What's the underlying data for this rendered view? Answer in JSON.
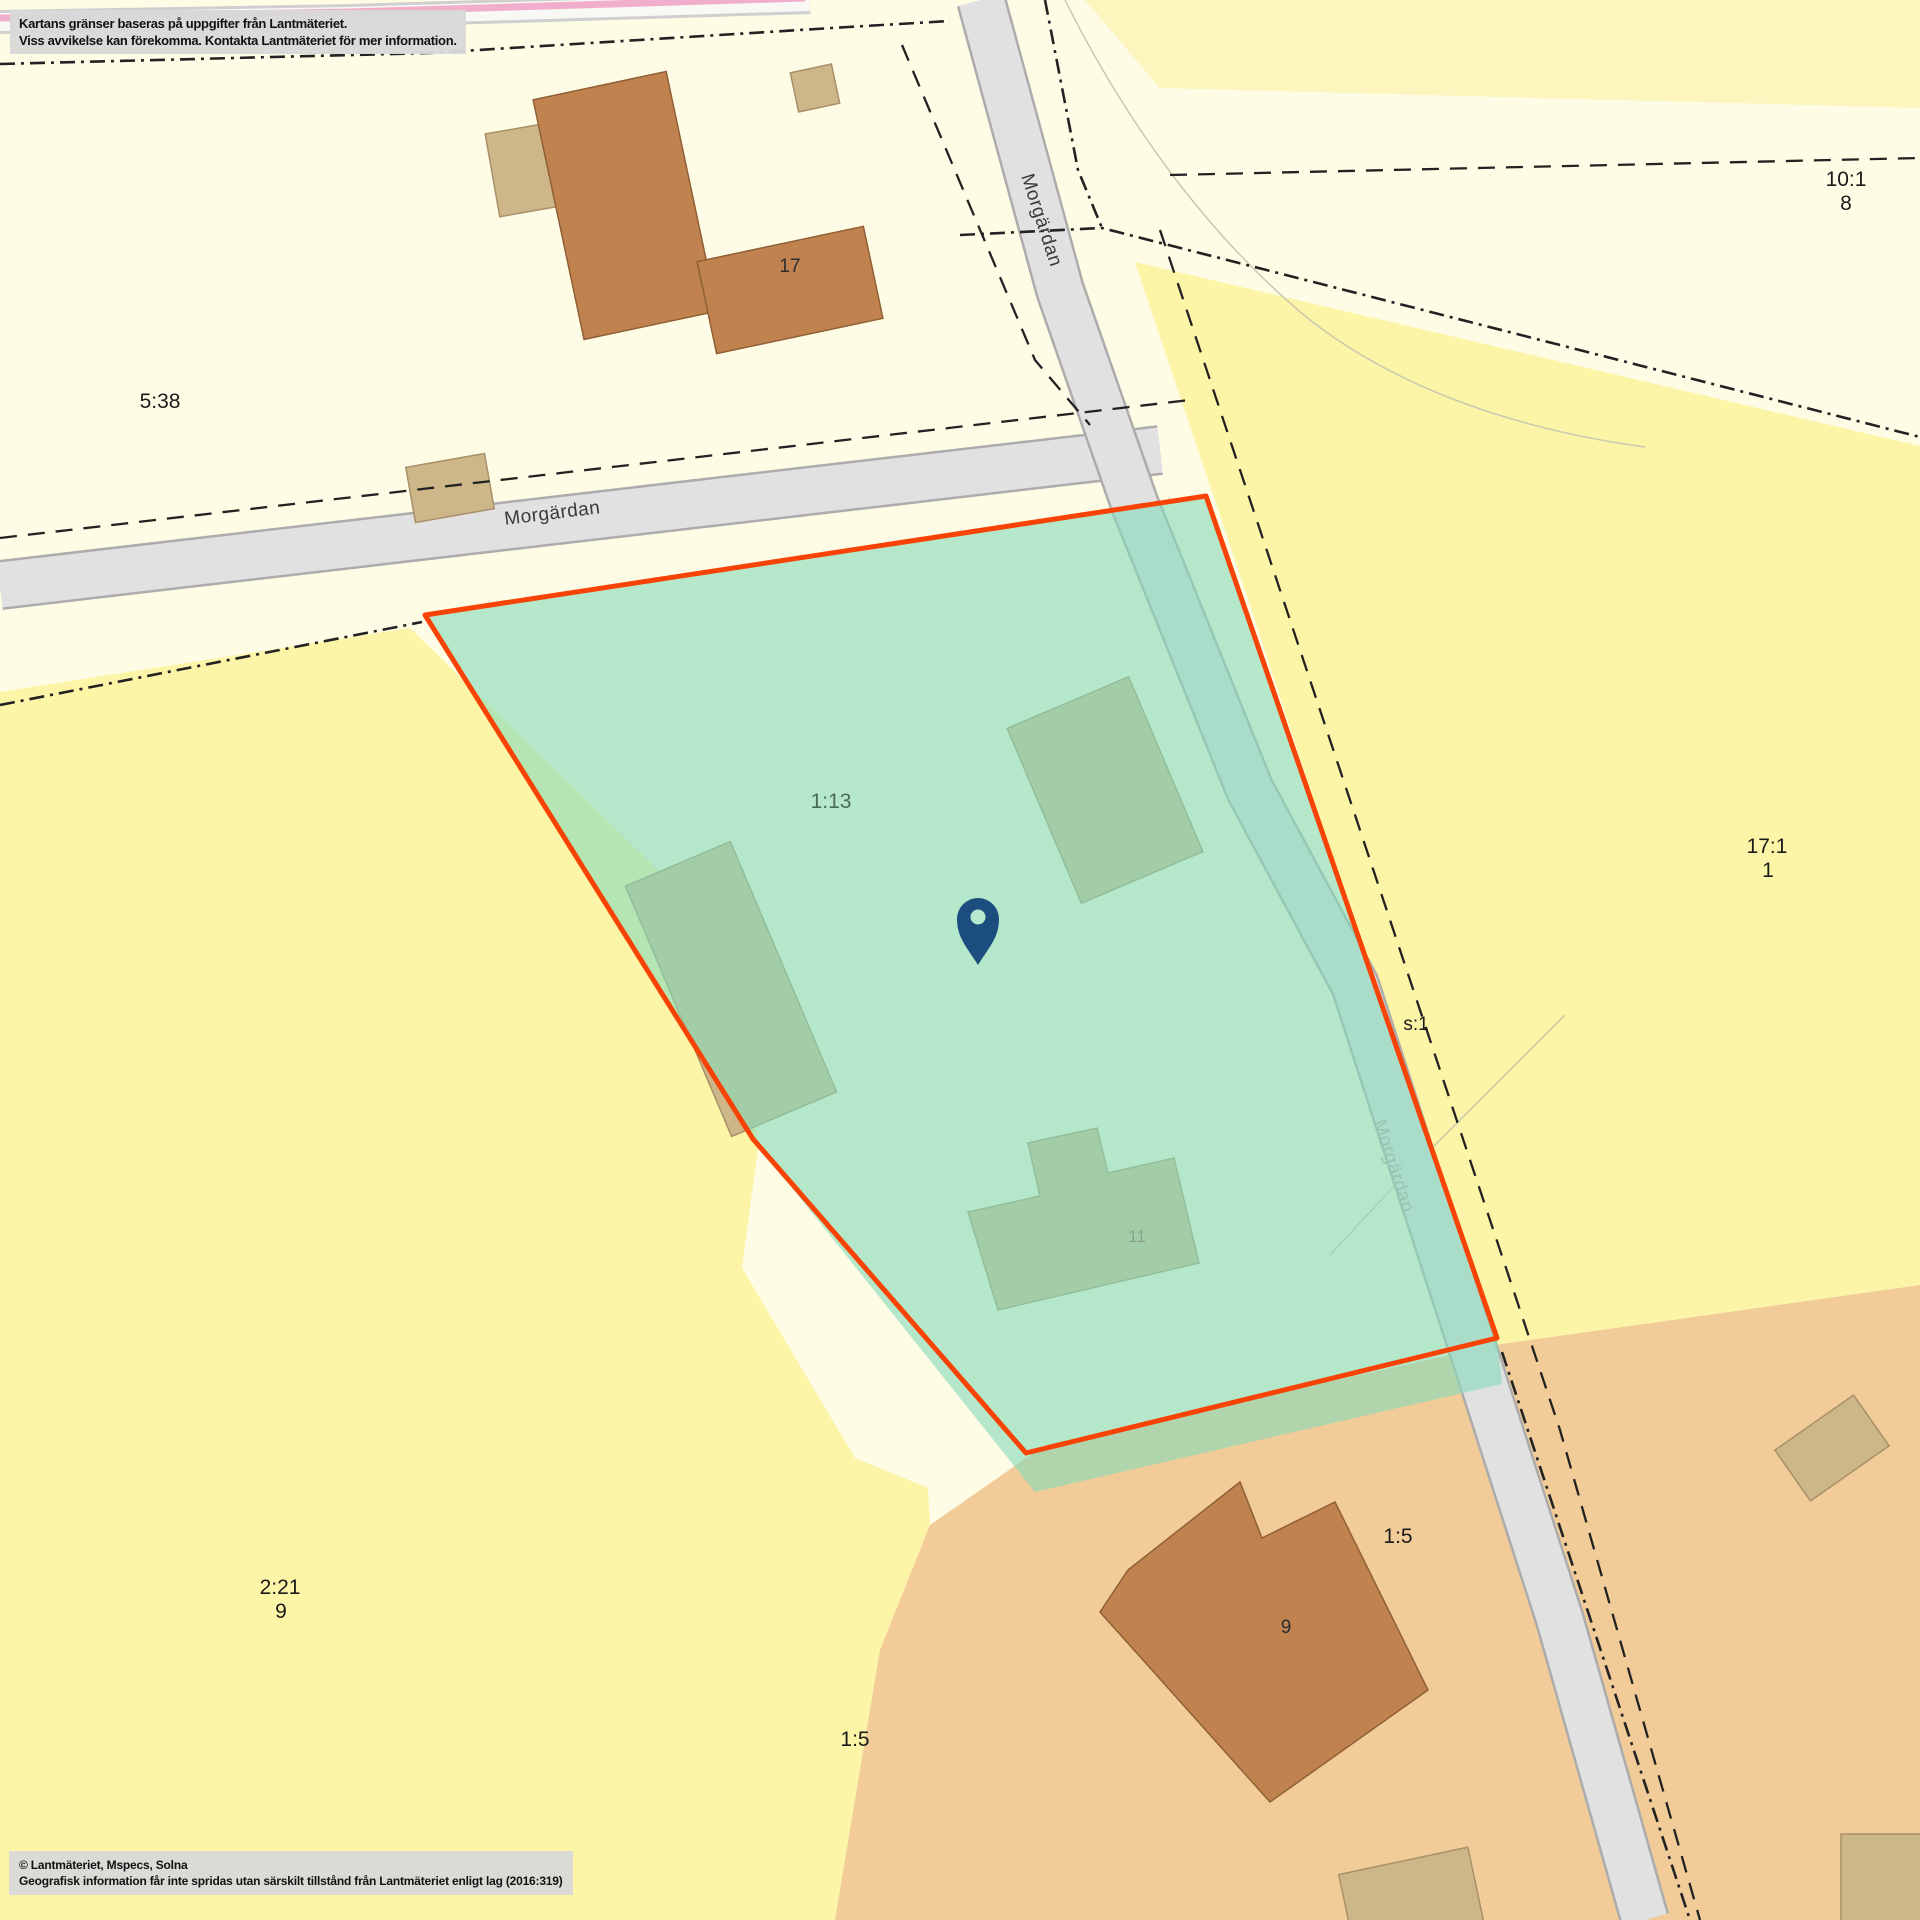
{
  "attribution": {
    "disclaimer_line1": "Kartans gränser baseras på uppgifter från Lantmäteriet.",
    "disclaimer_line2": "Viss avvikelse kan förekomma. Kontakta Lantmäteriet för mer information.",
    "copyright_line1": "© Lantmäteriet, Mspecs, Solna",
    "copyright_line2": "Geografisk information får inte spridas utan särskilt tillstånd från Lantmäteriet enligt lag (2016:319)"
  },
  "roads": {
    "name": "Morgärdan"
  },
  "parcels": {
    "p538": {
      "id": "5:38"
    },
    "p101": {
      "id": "10:1",
      "number": "8"
    },
    "p171": {
      "id": "17:1",
      "number": "1"
    },
    "s1": {
      "id": "s:1"
    },
    "p113": {
      "id": "1:13",
      "selected": true
    },
    "p221": {
      "id": "2:21",
      "number": "9"
    },
    "p15_east": {
      "id": "1:5"
    },
    "p15_south": {
      "id": "1:5"
    }
  },
  "buildings": {
    "b17": "17",
    "b11": "11",
    "b9": "9"
  },
  "marker": {
    "type": "map-pin"
  },
  "colors": {
    "base_cream": "#FFFCE6",
    "parcel_yellow": "#FCF4A6",
    "parcel_yellow_pale": "#FCF5BE",
    "parcel_tan": "#F2CC98",
    "road_gray": "#E1E1E1",
    "road_casing": "#ACACAC",
    "road_pink": "#F1AECA",
    "building_brown": "#C08350",
    "building_beige": "#CDB687",
    "selection_border": "#F84306",
    "selection_fill": "#86DBBB",
    "selected_label_green": "#49695A",
    "marker_blue": "#1B4E7E",
    "boundary_black": "#222222",
    "infobox_gray": "#D9D9D9"
  }
}
